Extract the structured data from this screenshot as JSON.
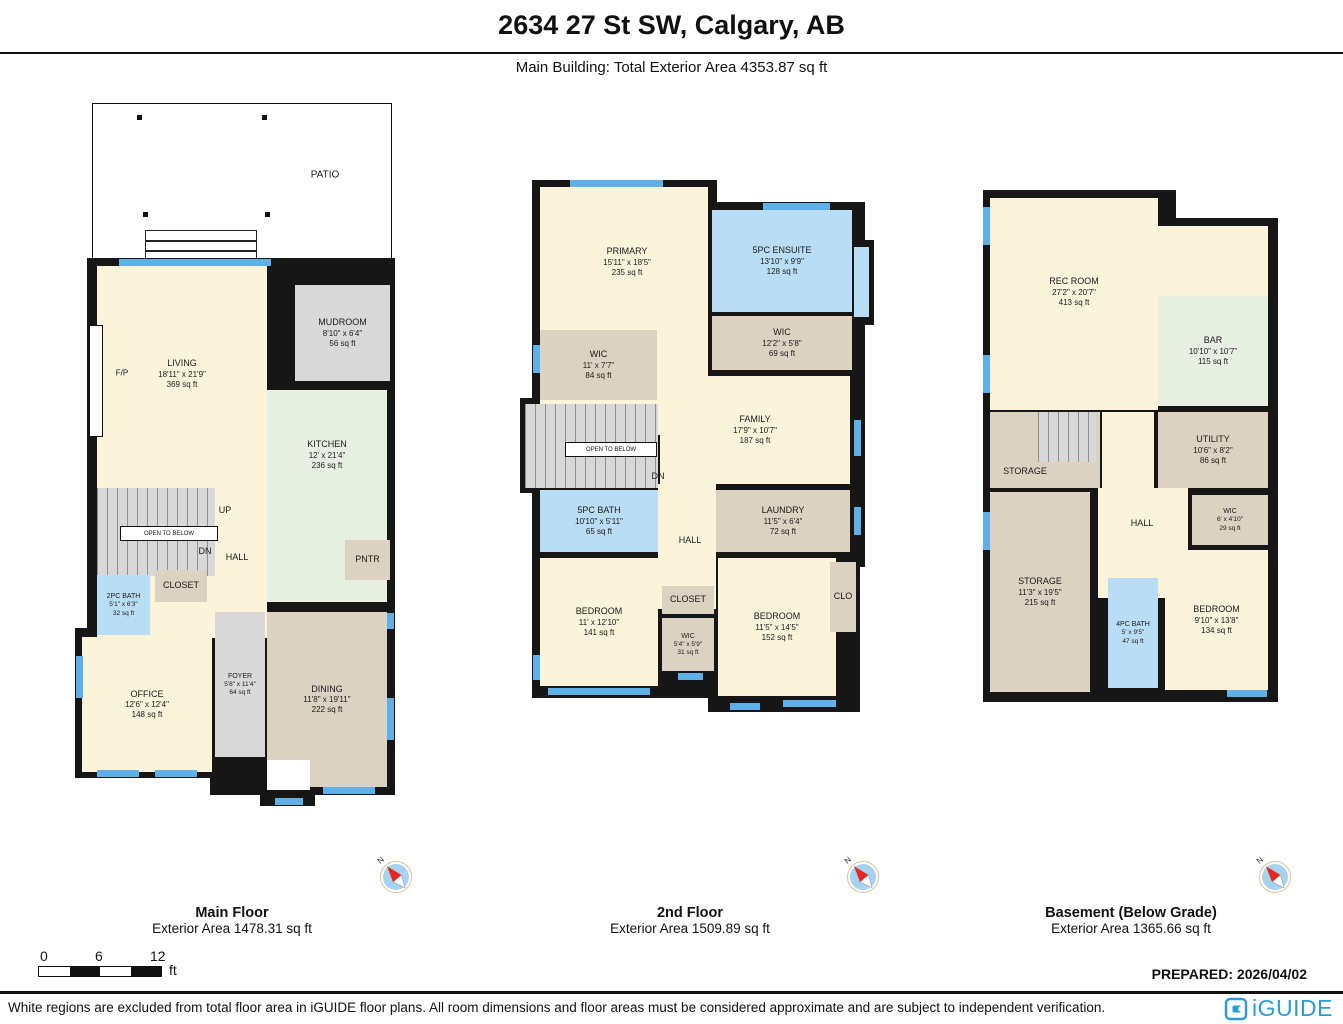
{
  "header": {
    "title": "2634 27 St SW, Calgary, AB",
    "subtitle": "Main Building: Total Exterior Area 4353.87 sq ft"
  },
  "colors": {
    "wall": "#161616",
    "room_cream": "#fbf3da",
    "room_mint": "#e7efe3",
    "room_bath_blue": "#b9ddf5",
    "room_grey": "#d9d9d9",
    "room_tan": "#dcd2c1",
    "window_blue": "#5fafe8",
    "logo_blue": "#2b9cd8"
  },
  "compass": {
    "n": "N"
  },
  "floors": {
    "main": {
      "label": "Main Floor",
      "area_label": "Exterior Area 1478.31 sq ft",
      "rooms": {
        "patio": {
          "name": "PATIO"
        },
        "living": {
          "name": "LIVING",
          "dims": "18'11\" x 21'9\"",
          "area": "369 sq ft"
        },
        "fireplace": {
          "name": "F/P"
        },
        "mudroom": {
          "name": "MUDROOM",
          "dims": "8'10\" x 6'4\"",
          "area": "56 sq ft"
        },
        "kitchen": {
          "name": "KITCHEN",
          "dims": "12' x 21'4\"",
          "area": "236 sq ft"
        },
        "up": {
          "name": "UP"
        },
        "dn": {
          "name": "DN"
        },
        "open_below": {
          "name": "OPEN TO BELOW"
        },
        "hall": {
          "name": "HALL"
        },
        "closet": {
          "name": "CLOSET"
        },
        "bath2": {
          "name": "2PC BATH",
          "dims": "5'1\" x 6'3\"",
          "area": "32 sq ft"
        },
        "pantry": {
          "name": "PNTR"
        },
        "dining": {
          "name": "DINING",
          "dims": "11'8\" x 19'11\"",
          "area": "222 sq ft"
        },
        "office": {
          "name": "OFFICE",
          "dims": "12'6\" x 12'4\"",
          "area": "148 sq ft"
        },
        "foyer": {
          "name": "FOYER",
          "dims": "5'8\" x 11'4\"",
          "area": "64 sq ft"
        }
      }
    },
    "second": {
      "label": "2nd Floor",
      "area_label": "Exterior Area 1509.89 sq ft",
      "rooms": {
        "primary": {
          "name": "PRIMARY",
          "dims": "15'11\" x 18'5\"",
          "area": "235 sq ft"
        },
        "ensuite": {
          "name": "5PC ENSUITE",
          "dims": "13'10\" x 9'9\"",
          "area": "128 sq ft"
        },
        "wic_right": {
          "name": "WIC",
          "dims": "12'2\" x 5'8\"",
          "area": "69 sq ft"
        },
        "wic_left": {
          "name": "WIC",
          "dims": "11' x 7'7\"",
          "area": "84 sq ft"
        },
        "family": {
          "name": "FAMILY",
          "dims": "17'9\" x 10'7\"",
          "area": "187 sq ft"
        },
        "open_below": {
          "name": "OPEN TO BELOW"
        },
        "dn": {
          "name": "DN"
        },
        "bath5": {
          "name": "5PC BATH",
          "dims": "10'10\" x 5'11\"",
          "area": "65 sq ft"
        },
        "laundry": {
          "name": "LAUNDRY",
          "dims": "11'5\" x 6'4\"",
          "area": "72 sq ft"
        },
        "hall": {
          "name": "HALL"
        },
        "bed_left": {
          "name": "BEDROOM",
          "dims": "11' x 12'10\"",
          "area": "141 sq ft"
        },
        "closet": {
          "name": "CLOSET"
        },
        "wic_mid": {
          "name": "WIC",
          "dims": "5'4\" x 5'9\"",
          "area": "31 sq ft"
        },
        "bed_right": {
          "name": "BEDROOM",
          "dims": "11'5\" x 14'5\"",
          "area": "152 sq ft"
        },
        "clo": {
          "name": "CLO"
        }
      }
    },
    "basement": {
      "label": "Basement (Below Grade)",
      "area_label": "Exterior Area 1365.66 sq ft",
      "rooms": {
        "rec": {
          "name": "REC ROOM",
          "dims": "27'2\" x 20'7\"",
          "area": "413 sq ft"
        },
        "bar": {
          "name": "BAR",
          "dims": "10'10\" x 10'7\"",
          "area": "115 sq ft"
        },
        "up": {
          "name": "UP"
        },
        "storage_upper": {
          "name": "STORAGE"
        },
        "utility": {
          "name": "UTILITY",
          "dims": "10'6\" x 8'2\"",
          "area": "86 sq ft"
        },
        "hall": {
          "name": "HALL"
        },
        "wic": {
          "name": "WIC",
          "dims": "6' x 4'10\"",
          "area": "29 sq ft"
        },
        "storage_lower": {
          "name": "STORAGE",
          "dims": "11'3\" x 19'5\"",
          "area": "215 sq ft"
        },
        "bath4": {
          "name": "4PC BATH",
          "dims": "5' x 9'5\"",
          "area": "47 sq ft"
        },
        "bedroom": {
          "name": "BEDROOM",
          "dims": "9'10\" x 13'8\"",
          "area": "134 sq ft"
        }
      }
    }
  },
  "scale": {
    "t0": "0",
    "t6": "6",
    "t12": "12",
    "unit": "ft"
  },
  "prepared": "PREPARED: 2026/04/02",
  "disclaimer": "White regions are excluded from total floor area in iGUIDE floor plans. All room dimensions and floor areas must be considered approximate and are subject to independent verification.",
  "logo": {
    "text": "iGUIDE"
  }
}
